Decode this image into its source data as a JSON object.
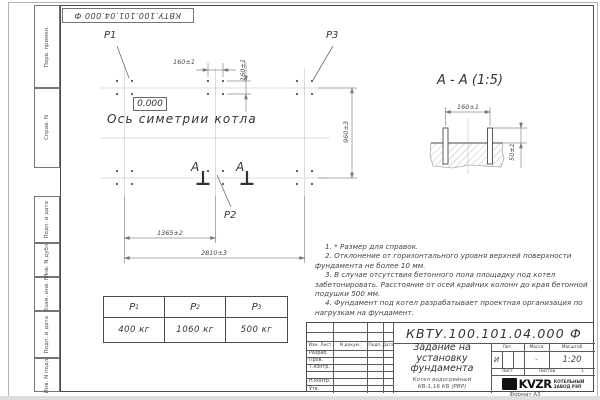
{
  "top_stamp": {
    "text": "КВТУ.100.101.04.000  Ф"
  },
  "margin_columns": {
    "col1": "Перв. примен.",
    "col2": "Справ. N",
    "col3": "Подп. и дата",
    "col4": "Инв. N дубл.",
    "col5": "Взам. инв. N",
    "col6": "Подп. и дата",
    "col7": "Инв. N подл."
  },
  "plan": {
    "labels": {
      "p1": "P1",
      "p2": "P2",
      "p3": "P3"
    },
    "level_mark": "0.000",
    "symmetry_axis": "Ось симетрии котла",
    "dim_bolt_spacing_h": "160±1",
    "dim_bolt_spacing_v": "160±1",
    "dim_height": "960±3",
    "dim_center": "1365±2",
    "dim_total": "2810±3",
    "section_mark_left": "А",
    "section_mark_right": "А"
  },
  "section_view": {
    "title": "А  -  А  (1:5)",
    "dim_bolt_spacing": "160±1",
    "dim_protrusion": "50±1"
  },
  "notes": {
    "line1": "1. * Размер для справок.",
    "line2": "2. Отклонение от горизонтального уровня верхней поверхности фундамента не более 10 мм.",
    "line3": "3. В случае отсутствия бетонного пола площадку под котел забетонировать. Расстояние от осей крайних колонн до края бетонной подушки 500 мм.",
    "line4": "4. Фундамент под котел разрабатывает проектная организация по нагрузкам на фундамент."
  },
  "load_table": {
    "headers": [
      {
        "name": "P",
        "index": "1"
      },
      {
        "name": "P",
        "index": "2"
      },
      {
        "name": "P",
        "index": "3"
      }
    ],
    "values": [
      "400 кг",
      "1060 кг",
      "500 кг"
    ]
  },
  "title_block": {
    "doc_number": "КВТУ.100.101.04.000  Ф",
    "title": "Задание на установку фундамента",
    "product": "Котел водогрейный КВ-1,16 КБ (РВР)",
    "cols": {
      "izm": "Изм. Лист",
      "doc": "N докум.",
      "sign": "Подп.",
      "date": "Дата"
    },
    "rows": {
      "r1": "Разраб.",
      "r2": "Пров.",
      "r3": "Т.контр.",
      "r4": "Н.контр.",
      "r5": "Утв."
    },
    "lit": {
      "header": "Лит.",
      "value": "И"
    },
    "mass": {
      "header": "Масса",
      "value": "-"
    },
    "scale": {
      "header": "Масштаб",
      "value": "1:20"
    },
    "sheet": {
      "label": "Лист"
    },
    "sheets": {
      "label": "Листов",
      "value": "1"
    },
    "company": {
      "logo": "KVZR",
      "name1": "КОТЕЛЬНЫЙ",
      "name2": "ЗАВОД РЭП"
    },
    "format": "Формат А3"
  }
}
